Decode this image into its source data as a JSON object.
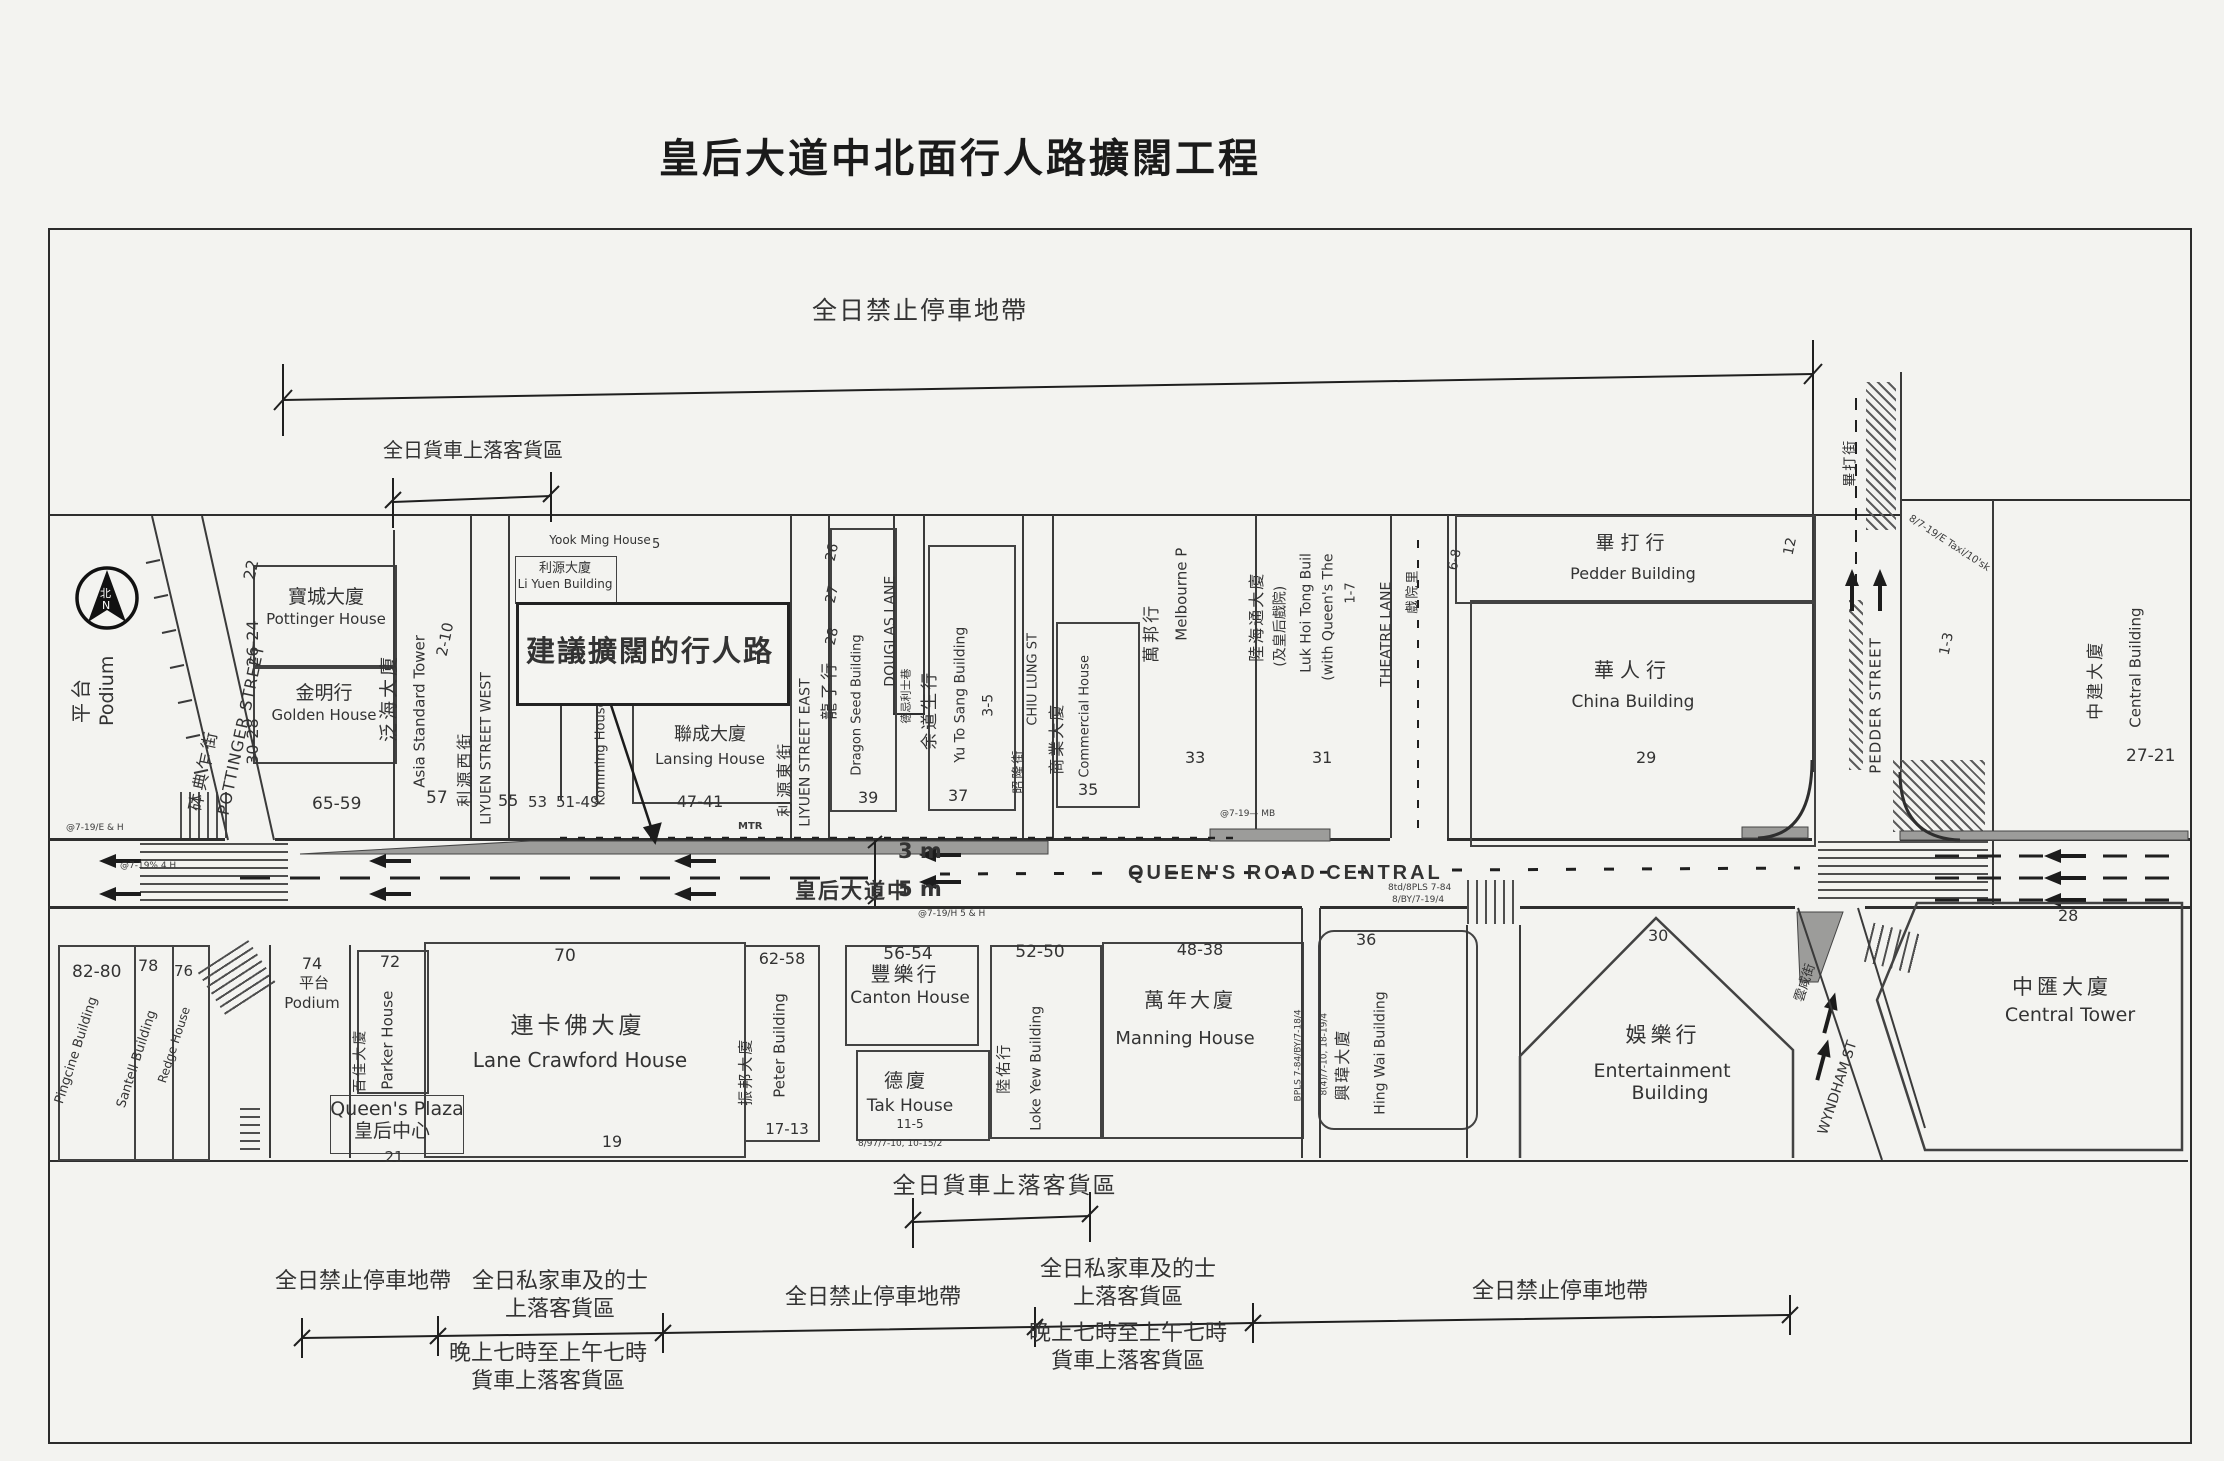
{
  "title": "皇后大道中北面行人路擴闊工程",
  "ann": {
    "no_stop_top": "全日禁止停車地帶",
    "load_top": "全日貨車上落客貨區",
    "load_bot": "全日貨車上落客貨區",
    "no_stop_l": "全日禁止停車地帶",
    "no_stop_m": "全日禁止停車地帶",
    "no_stop_r": "全日禁止停車地帶",
    "pvt1": "全日私家車及的士",
    "pvt2": "上落客貨區",
    "night1": "晚上七時至上午七時",
    "night2": "貨車上落客貨區",
    "proposed": "建議擴闊的行人路"
  },
  "road": {
    "zh": "皇后大道中",
    "en": "QUEEN'S ROAD CENTRAL",
    "d3": "3 m",
    "d5": "5 m"
  },
  "compass": {
    "zh": "北",
    "en": "N"
  },
  "streets": {
    "pottinger": {
      "zh": "砵典乍街",
      "en": "POTTINGER STREET"
    },
    "liyuen_w": {
      "zh": "利源西街",
      "en": "LIYUEN STREET WEST"
    },
    "liyuen_e": {
      "zh": "利源東街",
      "en": "LIYUEN STREET EAST"
    },
    "douglas": {
      "zh": "德忌利士巷",
      "en": "DOUGLAS LANE"
    },
    "chiu_lung": {
      "zh": "昭隆街",
      "en": "CHIU LUNG ST"
    },
    "theatre": {
      "zh": "戲院里",
      "en": "THEATRE LANE"
    },
    "pedder": {
      "zh": "畢打街",
      "en": "PEDDER STREET"
    },
    "wyndham": {
      "zh": "雲咸街",
      "en": "WYNDHAM ST"
    }
  },
  "north": {
    "podium": {
      "zh": "平台",
      "en": "Podium"
    },
    "pottinger_house": {
      "no": "26-24",
      "zh": "寶城大廈",
      "en": "Pottinger House"
    },
    "golden_house": {
      "no": "30-28",
      "zh": "金明行",
      "en": "Golden House"
    },
    "asia_standard": {
      "no": "2-10",
      "zh": "泛海大廈",
      "en": "Asia Standard Tower"
    },
    "liyuen_bldg": {
      "zh": "利源大廈",
      "en": "Li Yuen Building"
    },
    "yook_ming": {
      "no": "5",
      "en": "Yook Ming House"
    },
    "komming": {
      "en": "Komming House"
    },
    "lansing": {
      "no": "47-41",
      "zh": "聯成大廈",
      "en": "Lansing House"
    },
    "dragon_seed": {
      "no": "39",
      "zh": "龍子行",
      "en": "Dragon Seed Building"
    },
    "yu_to_sang": {
      "no1": "3-5",
      "no2": "37",
      "zh": "余道生行",
      "en": "Yu To Sang Building"
    },
    "commercial": {
      "no": "35",
      "zh": "商業大廈",
      "en": "Commercial House"
    },
    "melbourne": {
      "no": "33",
      "zh": "萬邦行",
      "en": "Melbourne P"
    },
    "luk_hoi_tong": {
      "no1": "1-7",
      "no2": "31",
      "zh1": "陸海通大廈",
      "zh2": "(及皇后戲院)",
      "en1": "Luk Hoi Tong Buil",
      "en2": "(with Queen's The"
    },
    "pedder_bldg": {
      "zh": "畢打行",
      "en": "Pedder Building"
    },
    "china_bldg": {
      "no": "29",
      "zh": "華人行",
      "en": "China Building"
    },
    "central_bldg": {
      "no": "1-3",
      "zh": "中建大廈",
      "en": "Central Building"
    }
  },
  "south": {
    "b8280": {
      "no": "82-80",
      "en": "Pingcine Building"
    },
    "santell": {
      "no": "78",
      "en": "Santell Building"
    },
    "redge": {
      "no": "76",
      "en": "Redge House"
    },
    "podium": {
      "no": "74",
      "zh": "平台",
      "en": "Podium"
    },
    "parker": {
      "no": "72",
      "zh": "百佳大廈",
      "en": "Parker House"
    },
    "queens_plaza": {
      "no": "21",
      "zh": "皇后中心",
      "en": "Queen's Plaza"
    },
    "lane_crawford": {
      "no1": "70",
      "no2": "19",
      "zh": "連卡佛大廈",
      "en": "Lane Crawford House"
    },
    "peter": {
      "no1": "62-58",
      "no2": "17-13",
      "zh": "振邦大廈",
      "en": "Peter Building"
    },
    "canton": {
      "no": "56-54",
      "zh": "豐樂行",
      "en": "Canton House"
    },
    "tak": {
      "no": "11-5",
      "zh": "德廈",
      "en": "Tak House"
    },
    "loke_yew": {
      "no": "52-50",
      "zh": "陸佑行",
      "en": "Loke Yew Building"
    },
    "manning": {
      "no": "48-38",
      "zh": "萬年大廈",
      "en": "Manning House"
    },
    "hing_wai": {
      "no": "36",
      "zh": "興瑋大廈",
      "en": "Hing Wai Building"
    },
    "entertainment": {
      "no": "30",
      "zh": "娛樂行",
      "en1": "Entertainment",
      "en2": "Building"
    },
    "central_tower": {
      "no": "28",
      "zh": "中匯大廈",
      "en": "Central Tower"
    }
  },
  "nums": {
    "n22": "22",
    "n6559": "65-59",
    "n57": "57",
    "n55": "55",
    "n53": "53",
    "n5149": "51-49",
    "n28": "28",
    "n27": "27",
    "n26": "26",
    "n12": "12",
    "n68": "6-8",
    "n2721": "27-21"
  },
  "micro": {
    "m1": "@7-19/E & H",
    "m2": "@7-19% 4 H",
    "m3": "@7-19/H 5 & H",
    "m4": "8td/8PLS 7-84",
    "m5": "8/BY/7-19/4",
    "m6": "BPLS 7-84/BY/7-18/4",
    "m7": "8/7-19/E Taxi/10'sk",
    "m8": "8/97/7-10, 10-15/2",
    "m9": "@7-19— MB",
    "m10": "MTR",
    "m11": "8(4)/7-10, 18-19/4"
  }
}
